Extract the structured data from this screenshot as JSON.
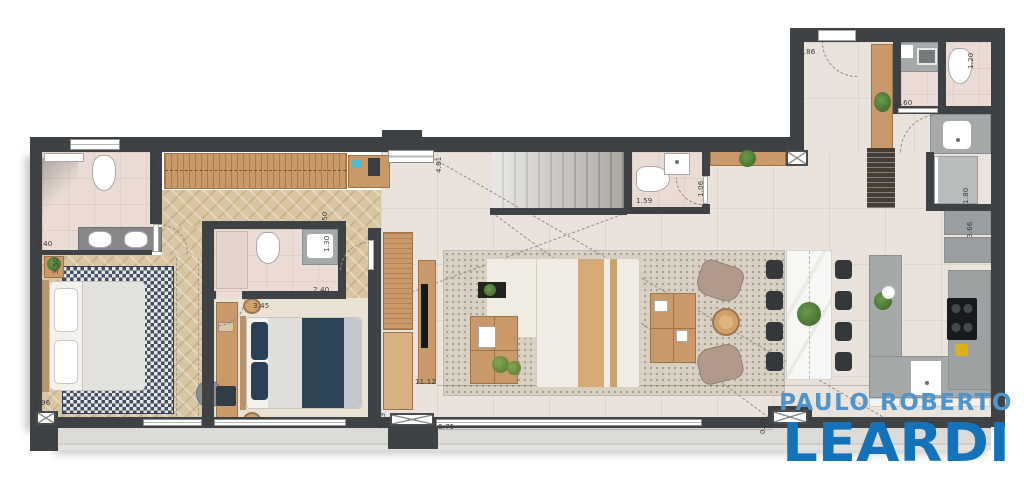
{
  "logo": {
    "line1": "PAULO ROBERTO",
    "line2": "LEARDI"
  },
  "dims": [
    {
      "id": "closet-depth",
      "v": "1.90"
    },
    {
      "id": "bath1-width",
      "v": "2.40"
    },
    {
      "id": "bedroom1-left-wall",
      "v": "3.50"
    },
    {
      "id": "bedroom1-width",
      "v": "3.96"
    },
    {
      "id": "bedroom2-width",
      "v": "3.45"
    },
    {
      "id": "bath2-width",
      "v": "2.40"
    },
    {
      "id": "hall-segment-a",
      "v": "1.50"
    },
    {
      "id": "hall-segment-b",
      "v": "1.30"
    },
    {
      "id": "stair-diagonal",
      "v": "4.81"
    },
    {
      "id": "living-length",
      "v": "11.12"
    },
    {
      "id": "living-left-wall",
      "v": "3.83"
    },
    {
      "id": "terrace-length",
      "v": "6.75"
    },
    {
      "id": "lavabo-width",
      "v": "1.59"
    },
    {
      "id": "lavabo-depth",
      "v": "1.06"
    },
    {
      "id": "entry-width",
      "v": "1.86"
    },
    {
      "id": "bath3-width",
      "v": "1.20"
    },
    {
      "id": "bath3-door",
      "v": "1.60"
    },
    {
      "id": "shower-width",
      "v": "1.80"
    },
    {
      "id": "kitchen-right-wall",
      "v": "3.66"
    },
    {
      "id": "ledge-width",
      "v": "0.65"
    }
  ],
  "colors": {
    "wall": "#3f4245",
    "wood_floor": "#d9c6a3",
    "furniture_wood": "#c9996a",
    "tile": "#e9e3dc",
    "bath_tile": "#eadcd4",
    "counter": "#a5a9aa",
    "rug_navy": "#3f4f68",
    "sofa": "#f0ece4",
    "logo_top_blue": "#4f95cb",
    "logo_main_blue": "#1273ba"
  }
}
